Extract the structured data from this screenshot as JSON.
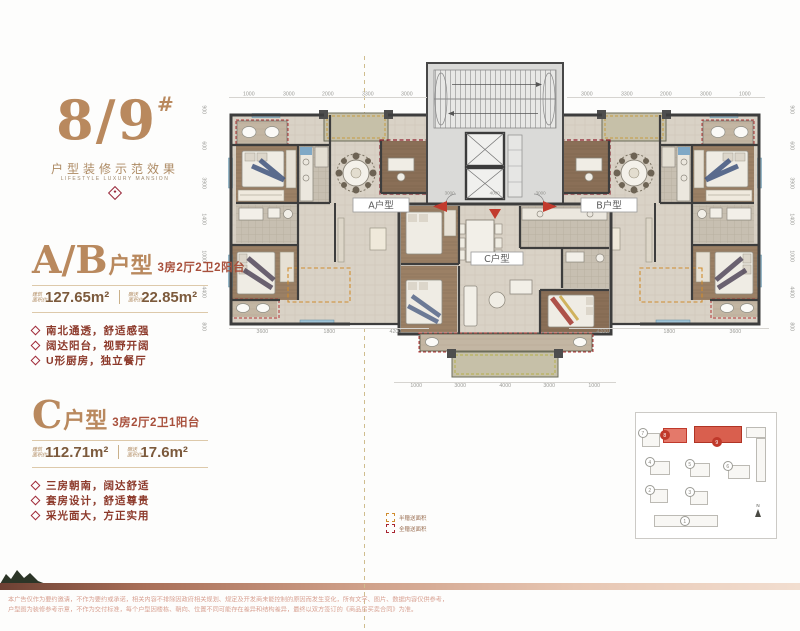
{
  "colors": {
    "bronze": "#b9895e",
    "brick_red": "#a8503c",
    "maroon": "#8c392a",
    "gift_full_red": "#b23434",
    "gift_half_orange": "#d08c2e",
    "keyplan_highlight": "#c0392b",
    "footer_copper": "#c08a6e",
    "disclaimer_pink": "#d8a091"
  },
  "left_panel": {
    "building_no": "8/9",
    "building_sup": "#",
    "subtitle": "户型装修示范效果",
    "subtitle_en": "LIFESTYLE LUXURY MANSION",
    "unit_ab": {
      "name": "A/B",
      "type_suffix": "户型",
      "spec": "3房2厅2卫2阳台",
      "area1_label_1": "建筑",
      "area1_label_2": "面积约",
      "area1_value": "127.65m²",
      "area2_label_1": "赠送",
      "area2_label_2": "面积约",
      "area2_value": "22.85m²",
      "features": [
        "南北通透，舒适感强",
        "阔达阳台，视野开阔",
        "U形厨房，独立餐厅"
      ]
    },
    "unit_c": {
      "name": "C",
      "type_suffix": "户型",
      "spec": "3房2厅2卫1阳台",
      "area1_label_1": "建筑",
      "area1_label_2": "面积约",
      "area1_value": "112.71m²",
      "area2_label_1": "赠送",
      "area2_label_2": "面积约",
      "area2_value": "17.6m²",
      "features": [
        "三房朝南，阔达舒适",
        "套房设计，舒适尊贵",
        "采光面大，方正实用"
      ]
    }
  },
  "plan": {
    "label_a": "A户型",
    "label_b": "B户型",
    "label_c": "C户型",
    "dims": {
      "top_left": [
        "1000",
        "3000",
        "2000",
        "3300",
        "3000"
      ],
      "top_right": [
        "3000",
        "3300",
        "2000",
        "3000",
        "1000"
      ],
      "left_col": [
        "900",
        "600",
        "3900",
        "1400",
        "1000",
        "4400",
        "800"
      ],
      "right_col": [
        "900",
        "600",
        "3900",
        "1400",
        "1000",
        "4400",
        "800"
      ],
      "bottom_left": [
        "3600",
        "1800",
        "4200"
      ],
      "bottom_right": [
        "4200",
        "1800",
        "3600"
      ],
      "bottom_center": [
        "1000",
        "3000",
        "4000",
        "3000",
        "1000"
      ],
      "core_bottom": [
        "3000",
        "4000",
        "3000"
      ]
    }
  },
  "legend": {
    "items": [
      "半赠送面积",
      "全赠送面积"
    ]
  },
  "keyplan": {
    "buildings": [
      "1",
      "2",
      "3",
      "4",
      "5",
      "6",
      "7",
      "8",
      "9"
    ],
    "north": "N"
  },
  "footer": {
    "line1": "本广告仅作为要约邀请，不作为要约或承诺，相关内容不排除因政府相关规划、规定及开发商未能控制的原因而发生变化，所有文字、图片、数据内容仅供参考，",
    "line2": "户型图为装修参考示意，不作为交付标准，每个户型因楼栋、朝向、位置不同可能存在差异和结构差异，最终以双方签订的《商品房买卖合同》为准。"
  }
}
